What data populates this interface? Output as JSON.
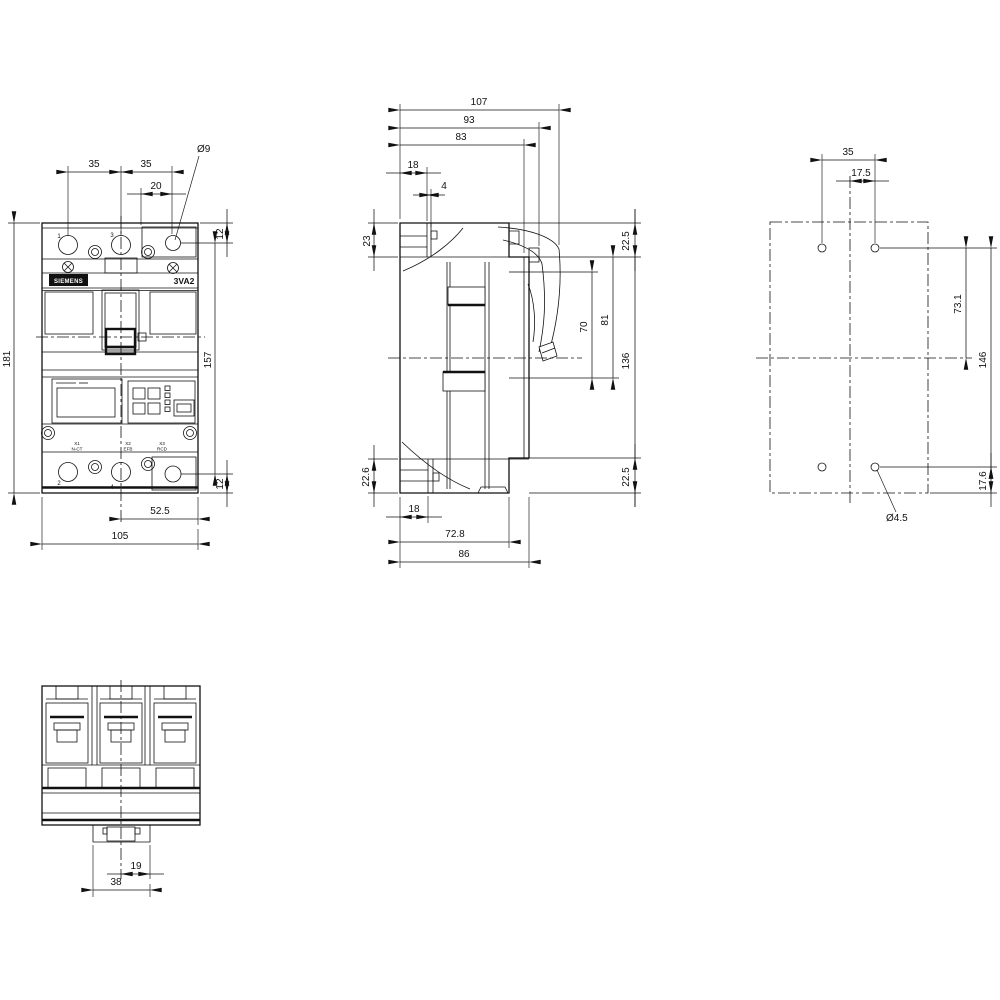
{
  "style": {
    "line_color": "#111111",
    "background": "#ffffff"
  },
  "front_view": {
    "brand": "SIEMENS",
    "model": "3VA2",
    "pole_top_left": "1",
    "pole_top_mid": "3",
    "pole_bottom_left": "2",
    "pole_bottom_mid": "4",
    "terminal_x1": "X1",
    "terminal_x1_sub": "N-CT",
    "terminal_x2": "X2",
    "terminal_x2_sub": "EFB",
    "terminal_x3": "X3",
    "terminal_x3_sub": "RCD",
    "dims": {
      "pitch_a": "35",
      "pitch_b": "35",
      "hole_offset": "20",
      "hole_dia": "Ø9",
      "hole_top": "12",
      "height": "181",
      "hole_span": "157",
      "hole_bottom": "12",
      "half_width": "52.5",
      "width": "105"
    }
  },
  "side_view": {
    "dims": {
      "depth_max": "107",
      "depth_latch": "93",
      "depth_panel": "83",
      "front_step": "18",
      "front_web": "4",
      "top_front": "23",
      "top_rear": "22.5",
      "terminal_upper": "70",
      "terminal_lower": "81",
      "panel_height": "136",
      "bottom_front": "22.6",
      "bottom_rear": "22.5",
      "foot_front": "18",
      "foot_depth": "72.8",
      "base_depth": "86"
    }
  },
  "mounting_view": {
    "dims": {
      "hole_pitch_h": "35",
      "hole_half_pitch": "17.5",
      "hole_to_center": "73.1",
      "hole_pitch_v": "146",
      "hole_bottom": "17.6",
      "hole_dia": "Ø4.5"
    }
  },
  "bottom_view": {
    "dims": {
      "handle_width": "19",
      "escutcheon_width": "38"
    }
  }
}
